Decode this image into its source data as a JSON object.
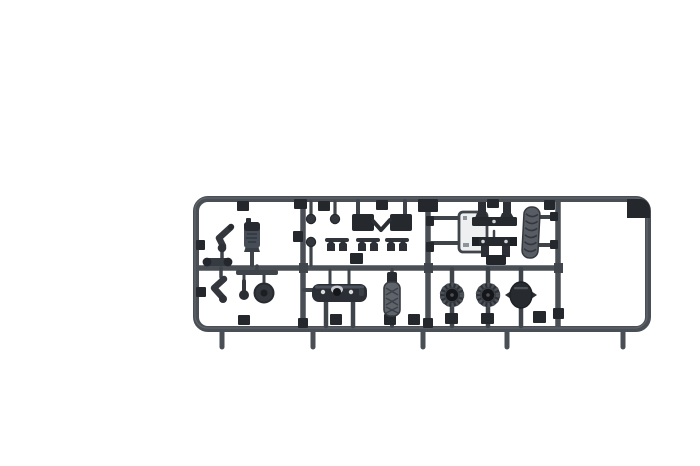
{
  "image": {
    "type": "product-photo",
    "subject": "Dark grey plastic scale-model sprue (injection-moulded parts tree) with small armour-model components, photographed on a plain white background",
    "orientation": "horizontal sprue centered in the middle band of the frame"
  },
  "colors": {
    "background": "#ffffff",
    "rail": "#4a4f56",
    "rail_dark": "#41464d",
    "rail_highlight": "#767b83",
    "stem": "#3f444b",
    "block": "#24272b",
    "part": "#33373d",
    "part_dark": "#26292e",
    "part_light": "#5f646c",
    "panel_fill": "#edeff1",
    "tooth": "#4d525a",
    "hub_dark": "#141619",
    "dot_light": "#d8dadd"
  },
  "sprue": {
    "frame": "rounded-rectangle runner frame with one horizontal mid-rail, three vertical divider rails, five gate stubs along the bottom edge and an empty bay on the right",
    "material": "dark grey styrene",
    "gate_stubs_bottom": 5,
    "bays": [
      "left parts bay",
      "middle top bay",
      "middle bottom bay",
      "right top bay",
      "right bottom bay",
      "empty right bay"
    ]
  },
  "parts": [
    {
      "name": "angled-pipe-section-upper",
      "count": 1,
      "bay": "left parts bay"
    },
    {
      "name": "cylindrical-housing",
      "count": 1,
      "bay": "left parts bay"
    },
    {
      "name": "angled-pipe-section-lower",
      "count": 1,
      "bay": "left parts bay"
    },
    {
      "name": "small-roller-bar",
      "count": 1,
      "bay": "left parts bay"
    },
    {
      "name": "ball-pin-and-small-wheel-hangers",
      "count": 2,
      "bay": "left parts bay"
    },
    {
      "name": "ball-head-pin",
      "count": 3,
      "bay": "middle top bay"
    },
    {
      "name": "mount-blocks-with-v-link",
      "count": 1,
      "bay": "middle top bay"
    },
    {
      "name": "suspension-clip-pair",
      "count": 3,
      "bay": "middle top bay"
    },
    {
      "name": "hull-plate-with-hatch-and-lights",
      "count": 1,
      "bay": "middle bottom bay"
    },
    {
      "name": "textured-muffler",
      "count": 1,
      "bay": "middle bottom bay"
    },
    {
      "name": "flat-outlined-panel",
      "count": 1,
      "bay": "right top bay"
    },
    {
      "name": "mounting-bracket-rail",
      "count": 2,
      "bay": "right top bay"
    },
    {
      "name": "textured-exhaust-pipe",
      "count": 1,
      "bay": "right top bay"
    },
    {
      "name": "toothed-drive-sprocket",
      "count": 2,
      "bay": "right bottom bay"
    },
    {
      "name": "idler-wheel",
      "count": 1,
      "bay": "right bottom bay"
    }
  ]
}
